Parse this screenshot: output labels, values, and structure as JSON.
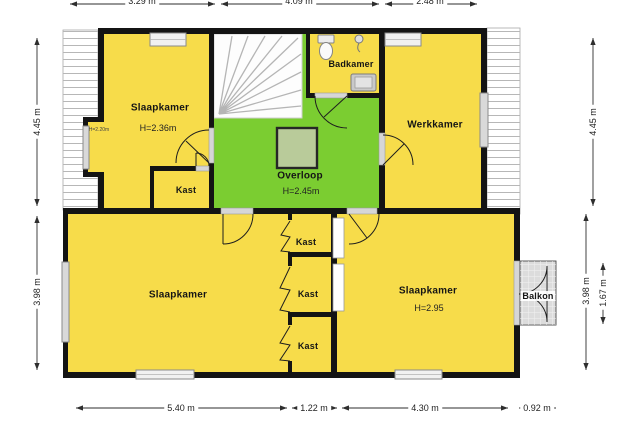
{
  "plan": {
    "rooms": {
      "slaapkamer_tl": {
        "name": "Slaapkamer",
        "height": "H=2.36m",
        "knee_wall_height": "H=2.20m"
      },
      "kast_hal": {
        "name": "Kast"
      },
      "overloop": {
        "name": "Overloop",
        "height": "H=2.45m"
      },
      "badkamer": {
        "name": "Badkamer"
      },
      "werkkamer": {
        "name": "Werkkamer"
      },
      "slaapkamer_bl": {
        "name": "Slaapkamer"
      },
      "kast_1": {
        "name": "Kast"
      },
      "kast_2": {
        "name": "Kast"
      },
      "kast_3": {
        "name": "Kast"
      },
      "slaapkamer_br": {
        "name": "Slaapkamer",
        "height": "H=2.95"
      },
      "balkon": {
        "name": "Balkon"
      }
    },
    "dimensions": {
      "top": [
        "3.29 m",
        "4.09 m",
        "2.48 m"
      ],
      "bottom": [
        "5.40 m",
        "1.22 m",
        "4.30 m",
        "0.92 m"
      ],
      "left": [
        "4.45 m",
        "3.98 m"
      ],
      "right": [
        "4.45 m",
        "3.98 m",
        "1.67 m"
      ]
    },
    "icons": {
      "toilet": "toilet-icon",
      "shower": "shower-icon",
      "washbasin": "washbasin-icon"
    },
    "colors": {
      "room_fill": "#f7dc4a",
      "hall_fill": "#7bcd31",
      "wall": "#141414",
      "window": "#d9d9d9",
      "balcony_fill": "#dcdcdc",
      "void_square": "#b9cb9a"
    }
  }
}
